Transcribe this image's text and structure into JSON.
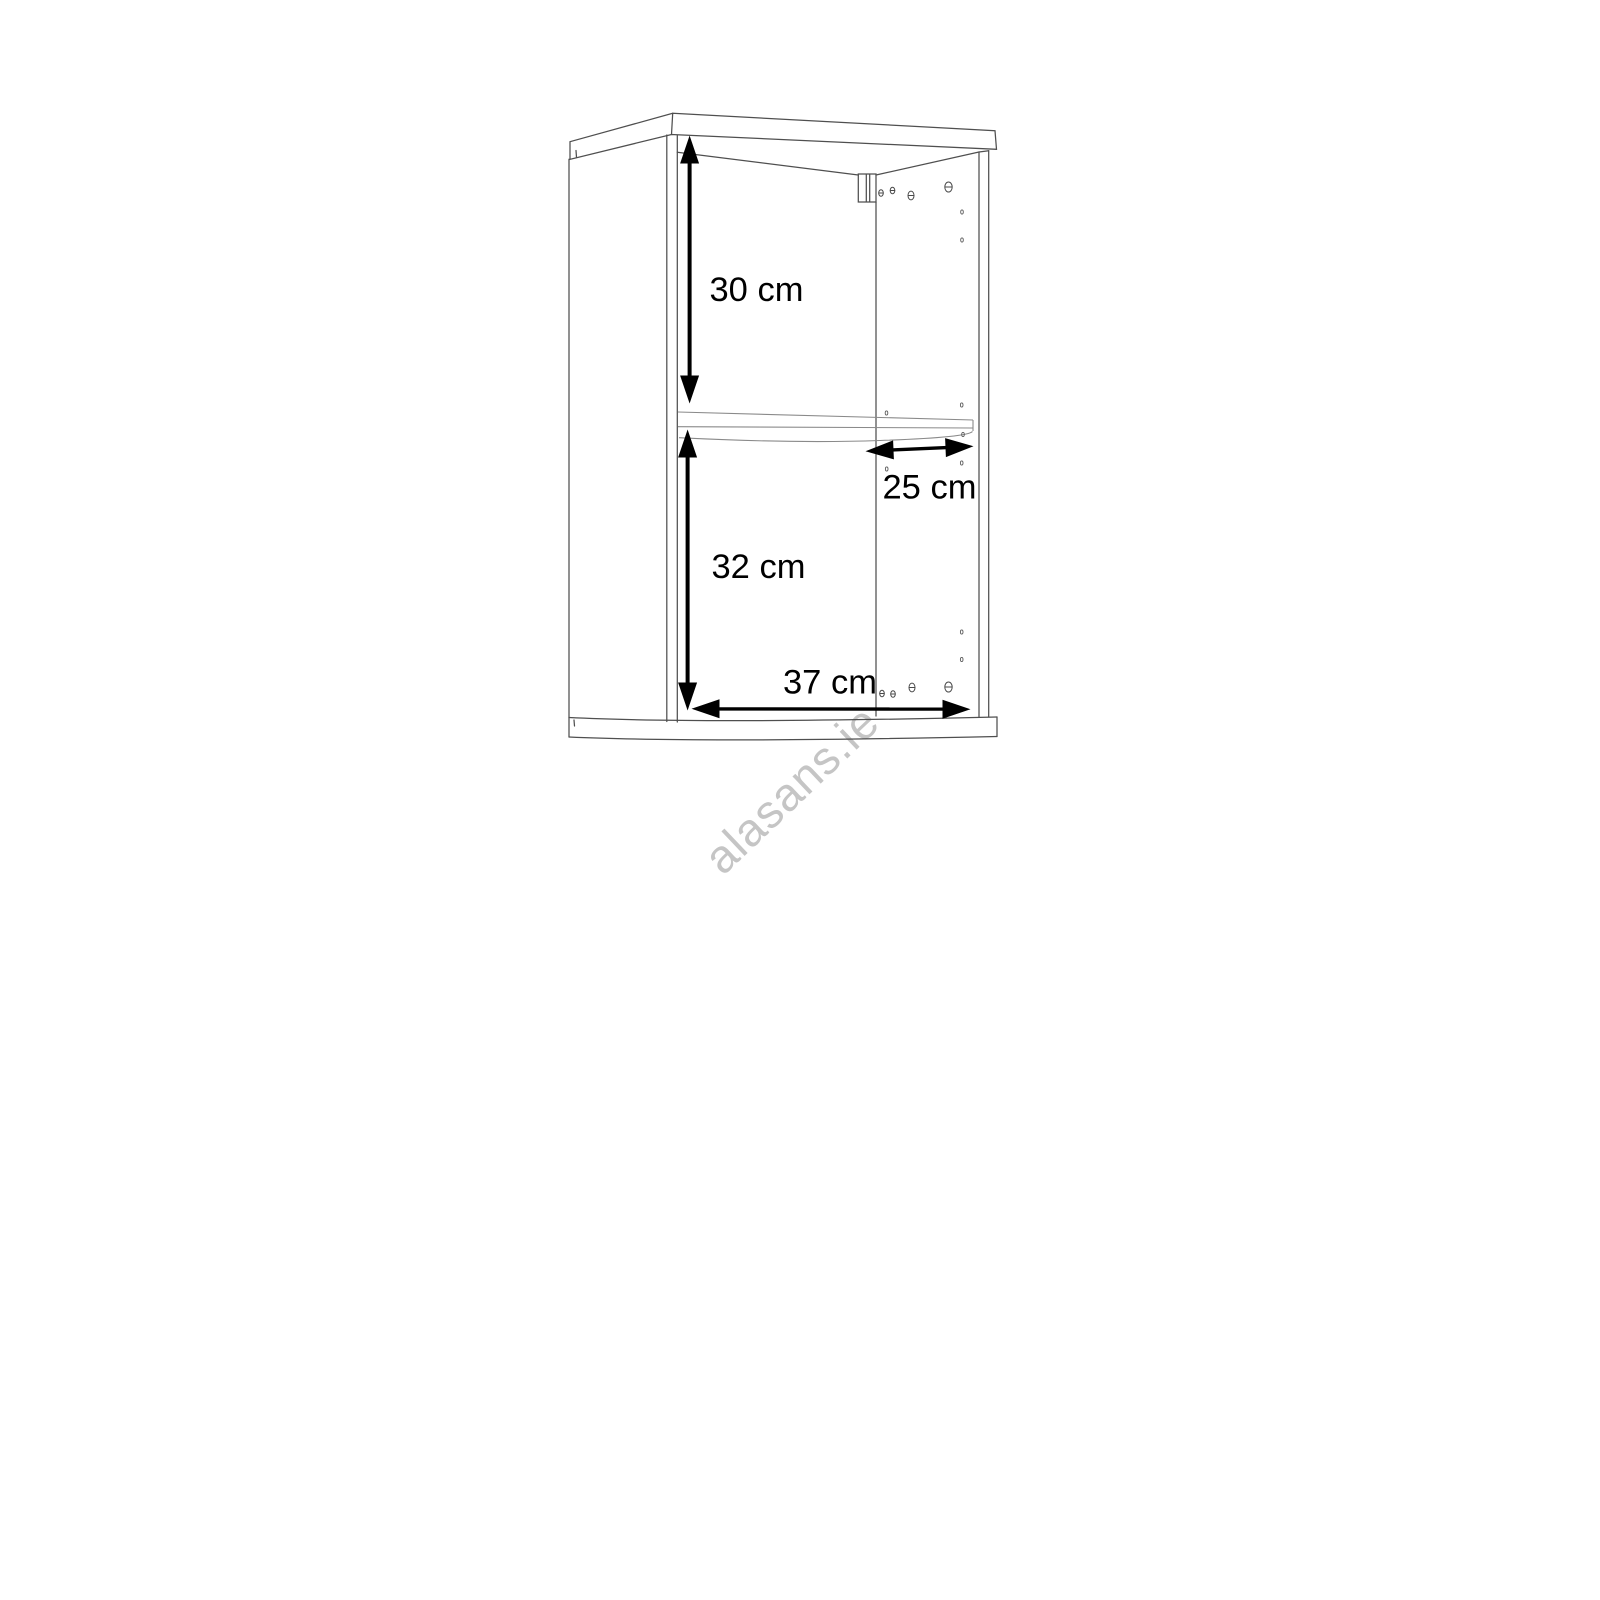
{
  "diagram": {
    "title": "Wall cabinet dimension drawing",
    "type": "isometric wireframe line drawing",
    "background": "#ffffff",
    "line_color": "#4f4f4f",
    "dimension_color": "#000000",
    "units": "cm",
    "dimensions": [
      {
        "id": "upper-compartment-height",
        "label": "30 cm",
        "orientation": "vertical"
      },
      {
        "id": "shelf-depth",
        "label": "25 cm",
        "orientation": "horizontal"
      },
      {
        "id": "lower-compartment-height",
        "label": "32 cm",
        "orientation": "vertical"
      },
      {
        "id": "interior-width",
        "label": "37 cm",
        "orientation": "horizontal"
      }
    ],
    "watermark": {
      "text": "alasans.ie",
      "color": "#c5c5c5",
      "rotation_deg": -43.5
    }
  }
}
